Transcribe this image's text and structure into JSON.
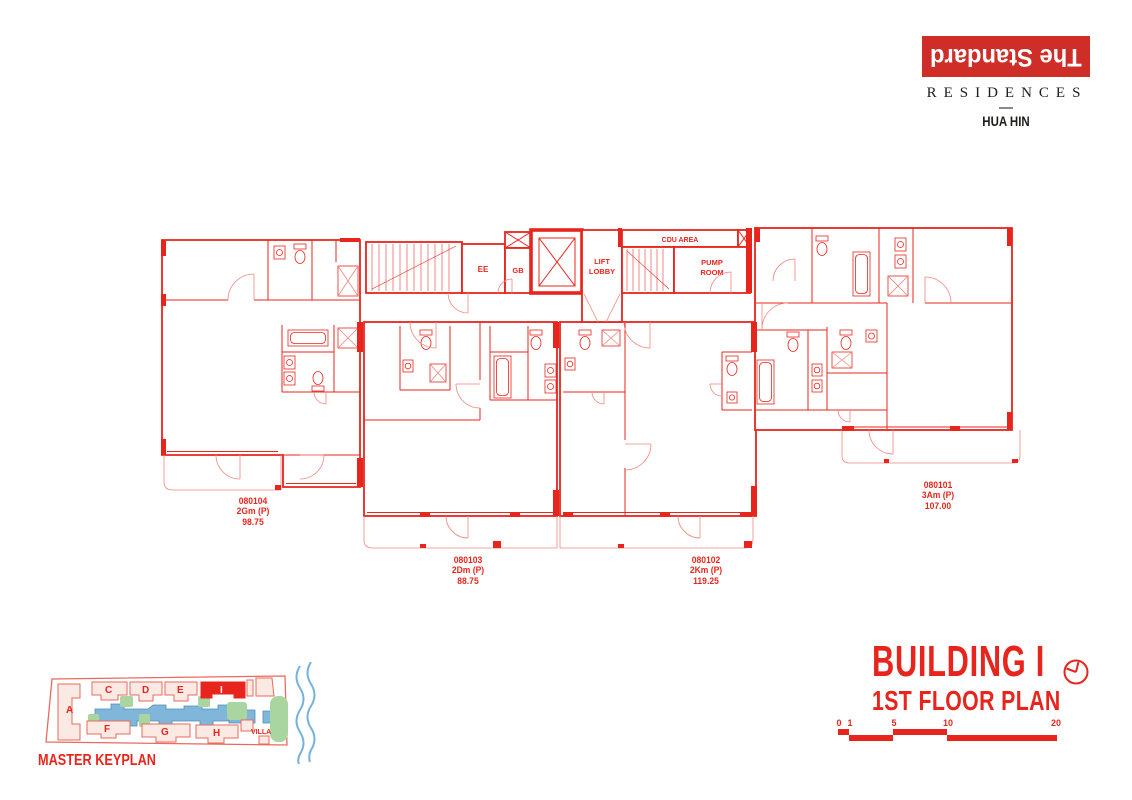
{
  "brand": {
    "logo_text": "The Standard",
    "residences": "RESIDENCES",
    "location": "HUA HIN"
  },
  "plan": {
    "core_labels": {
      "ee": "EE",
      "gb": "GB",
      "lift_line1": "LIFT",
      "lift_line2": "LOBBY",
      "cdu_area": "CDU AREA",
      "pump_line1": "PUMP",
      "pump_line2": "ROOM"
    },
    "units": [
      {
        "number": "080104",
        "type": "2Gm (P)",
        "area": "98.75"
      },
      {
        "number": "080103",
        "type": "2Dm (P)",
        "area": "88.75"
      },
      {
        "number": "080102",
        "type": "2Km (P)",
        "area": "119.25"
      },
      {
        "number": "080101",
        "type": "3Am (P)",
        "area": "107.00"
      }
    ]
  },
  "title_block": {
    "building": "BUILDING I",
    "floor": "1ST FLOOR PLAN",
    "scale_ticks": [
      "0",
      "1",
      "5",
      "10",
      "20"
    ]
  },
  "keyplan": {
    "label": "MASTER KEYPLAN",
    "villa": "VILLA",
    "highlighted": "I",
    "buildings": {
      "a": "A",
      "c": "C",
      "d": "D",
      "e": "E",
      "f": "F",
      "g": "G",
      "h": "H",
      "i": "I"
    }
  },
  "colors": {
    "red": "#E8251D",
    "red-light": "#F2857C",
    "logo-red": "#CF2D28",
    "ink": "#1D1D1B",
    "divider-gray": "#8A8A8A",
    "keyplan-outline": "#E96A5E",
    "keyplan-fill": "#FBE9E4",
    "pool-blue": "#7FB6D9",
    "pool-edge": "#4E8FB8",
    "green": "#A9D6A0",
    "wave-blue": "#74B3DE"
  }
}
